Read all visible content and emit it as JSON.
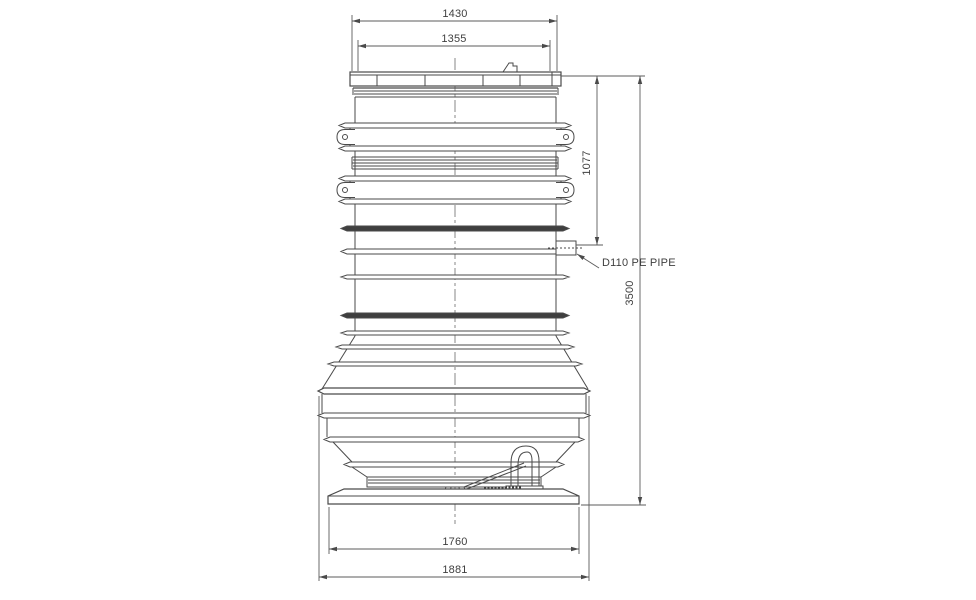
{
  "drawing": {
    "type": "technical-dimension-drawing",
    "subject": "pump station tank elevation view",
    "units": "mm",
    "colors": {
      "background": "#ffffff",
      "line": "#4a4a4a",
      "dark_band": "#3f3f3f",
      "text": "#3f3f3f"
    },
    "dimensions": {
      "lid_outer_width": "1430",
      "lid_inner_width": "1355",
      "inlet_height_from_top": "1077",
      "overall_height": "3500",
      "base_plate_width": "1760",
      "max_body_width": "1881"
    },
    "annotations": {
      "outlet_pipe_label": "D110 PE PIPE"
    }
  }
}
